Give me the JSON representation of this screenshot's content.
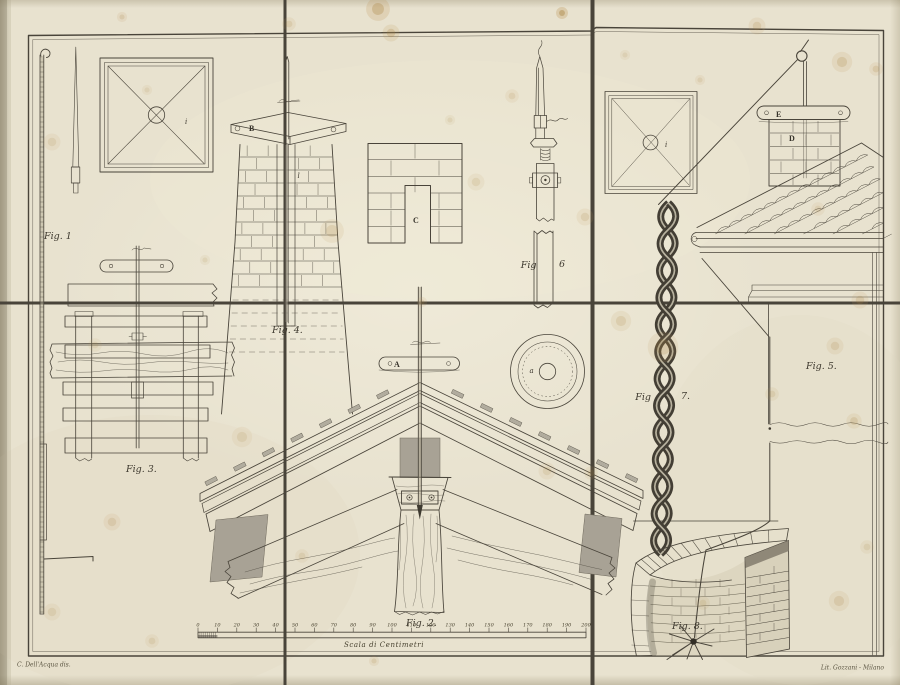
{
  "plate": {
    "colors": {
      "paper": "#e9e3d1",
      "ink": "#453f33",
      "shade_grey": "#a8a295",
      "stain": "#b6904f"
    },
    "labels": {
      "fig1": "Fig. 1",
      "fig2": "Fig. 2.",
      "fig3": "Fig. 3.",
      "fig4": "Fig. 4.",
      "fig5": "Fig. 5.",
      "fig6_fig": "Fig",
      "fig6_num": "6",
      "fig7_fig": "Fig",
      "fig7_num": "7.",
      "fig8": "Fig. 8."
    },
    "letters": {
      "A": "A",
      "B": "B",
      "C": "C",
      "D": "D",
      "E": "E",
      "i1": "i",
      "i2": "i",
      "a": "a",
      "l": "l"
    },
    "scale": {
      "caption": "Scala di Centimetri",
      "unit_ticks": [
        "0",
        "10",
        "20",
        "30",
        "40",
        "50",
        "60",
        "70",
        "80",
        "90",
        "100",
        "110",
        "120",
        "130",
        "140",
        "150",
        "160",
        "170",
        "180",
        "190",
        "200"
      ]
    },
    "credits": {
      "artist": "C. Dell'Acqua dis.",
      "lithographer": "Lit. Gozzani - Milano"
    }
  }
}
